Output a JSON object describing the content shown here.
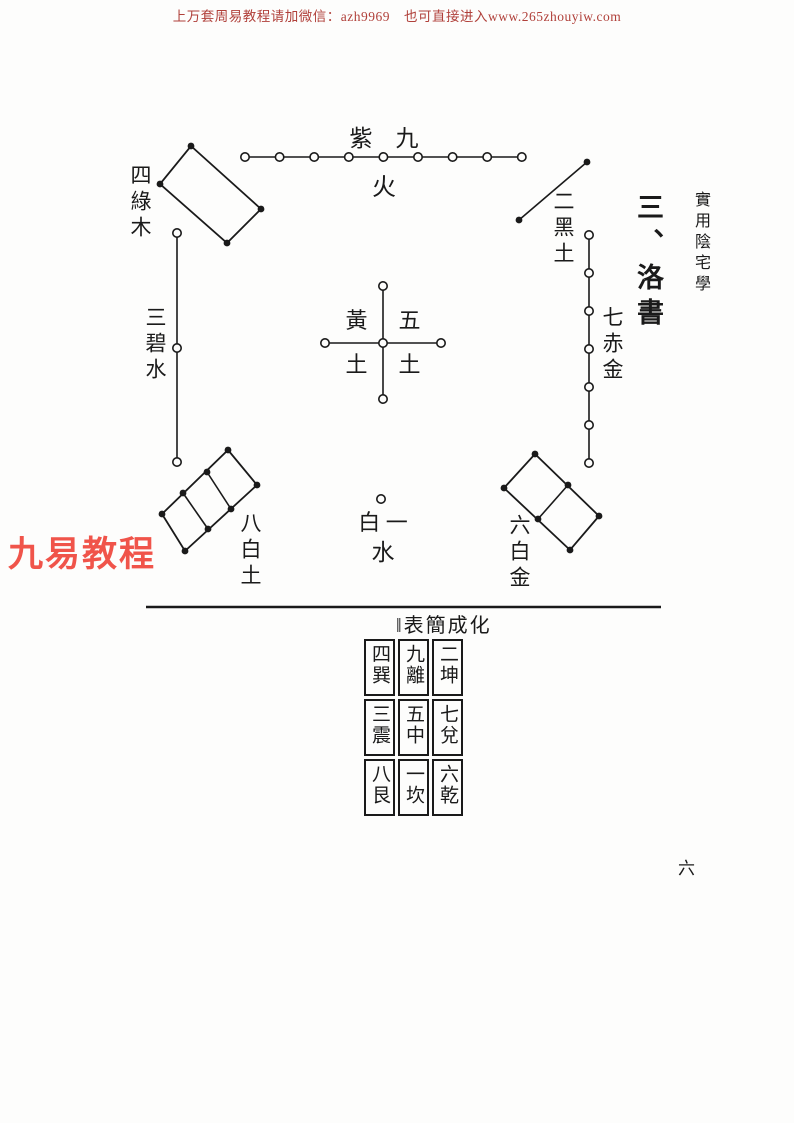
{
  "page": {
    "header": "上万套周易教程请加微信：azh9969　也可直接进入www.265zhouyiw.com",
    "watermark": "九易教程",
    "margin_title": "實用陰宅學",
    "section_heading": "三、洛書",
    "page_number": "六"
  },
  "diagram": {
    "nine": {
      "label_top": "紫　九",
      "label_bottom": "火",
      "dots": 9
    },
    "four": {
      "label": "四綠木",
      "dots": 4
    },
    "two": {
      "label": "二黑土",
      "dots": 2
    },
    "three": {
      "label": "三碧水",
      "dots": 3
    },
    "seven": {
      "label": "七赤金",
      "dots": 7
    },
    "five": {
      "tl": "黃",
      "tr": "五",
      "bl": "土",
      "br": "土",
      "dots": 5
    },
    "eight": {
      "label": "八白土",
      "dots": 8
    },
    "one": {
      "label_top": "白 一",
      "label_bottom": "水",
      "dots": 1
    },
    "six": {
      "label": "六白金",
      "dots": 6
    }
  },
  "table": {
    "caption": "‖表簡成化",
    "rows": [
      [
        "四巽",
        "九離",
        "二坤"
      ],
      [
        "三震",
        "五中",
        "七兌"
      ],
      [
        "八艮",
        "一坎",
        "六乾"
      ]
    ]
  },
  "colors": {
    "ink": "#1a1a1a",
    "header_red": "#b0403a",
    "watermark_red": "#f0544a",
    "paper": "#fdfdfc"
  }
}
